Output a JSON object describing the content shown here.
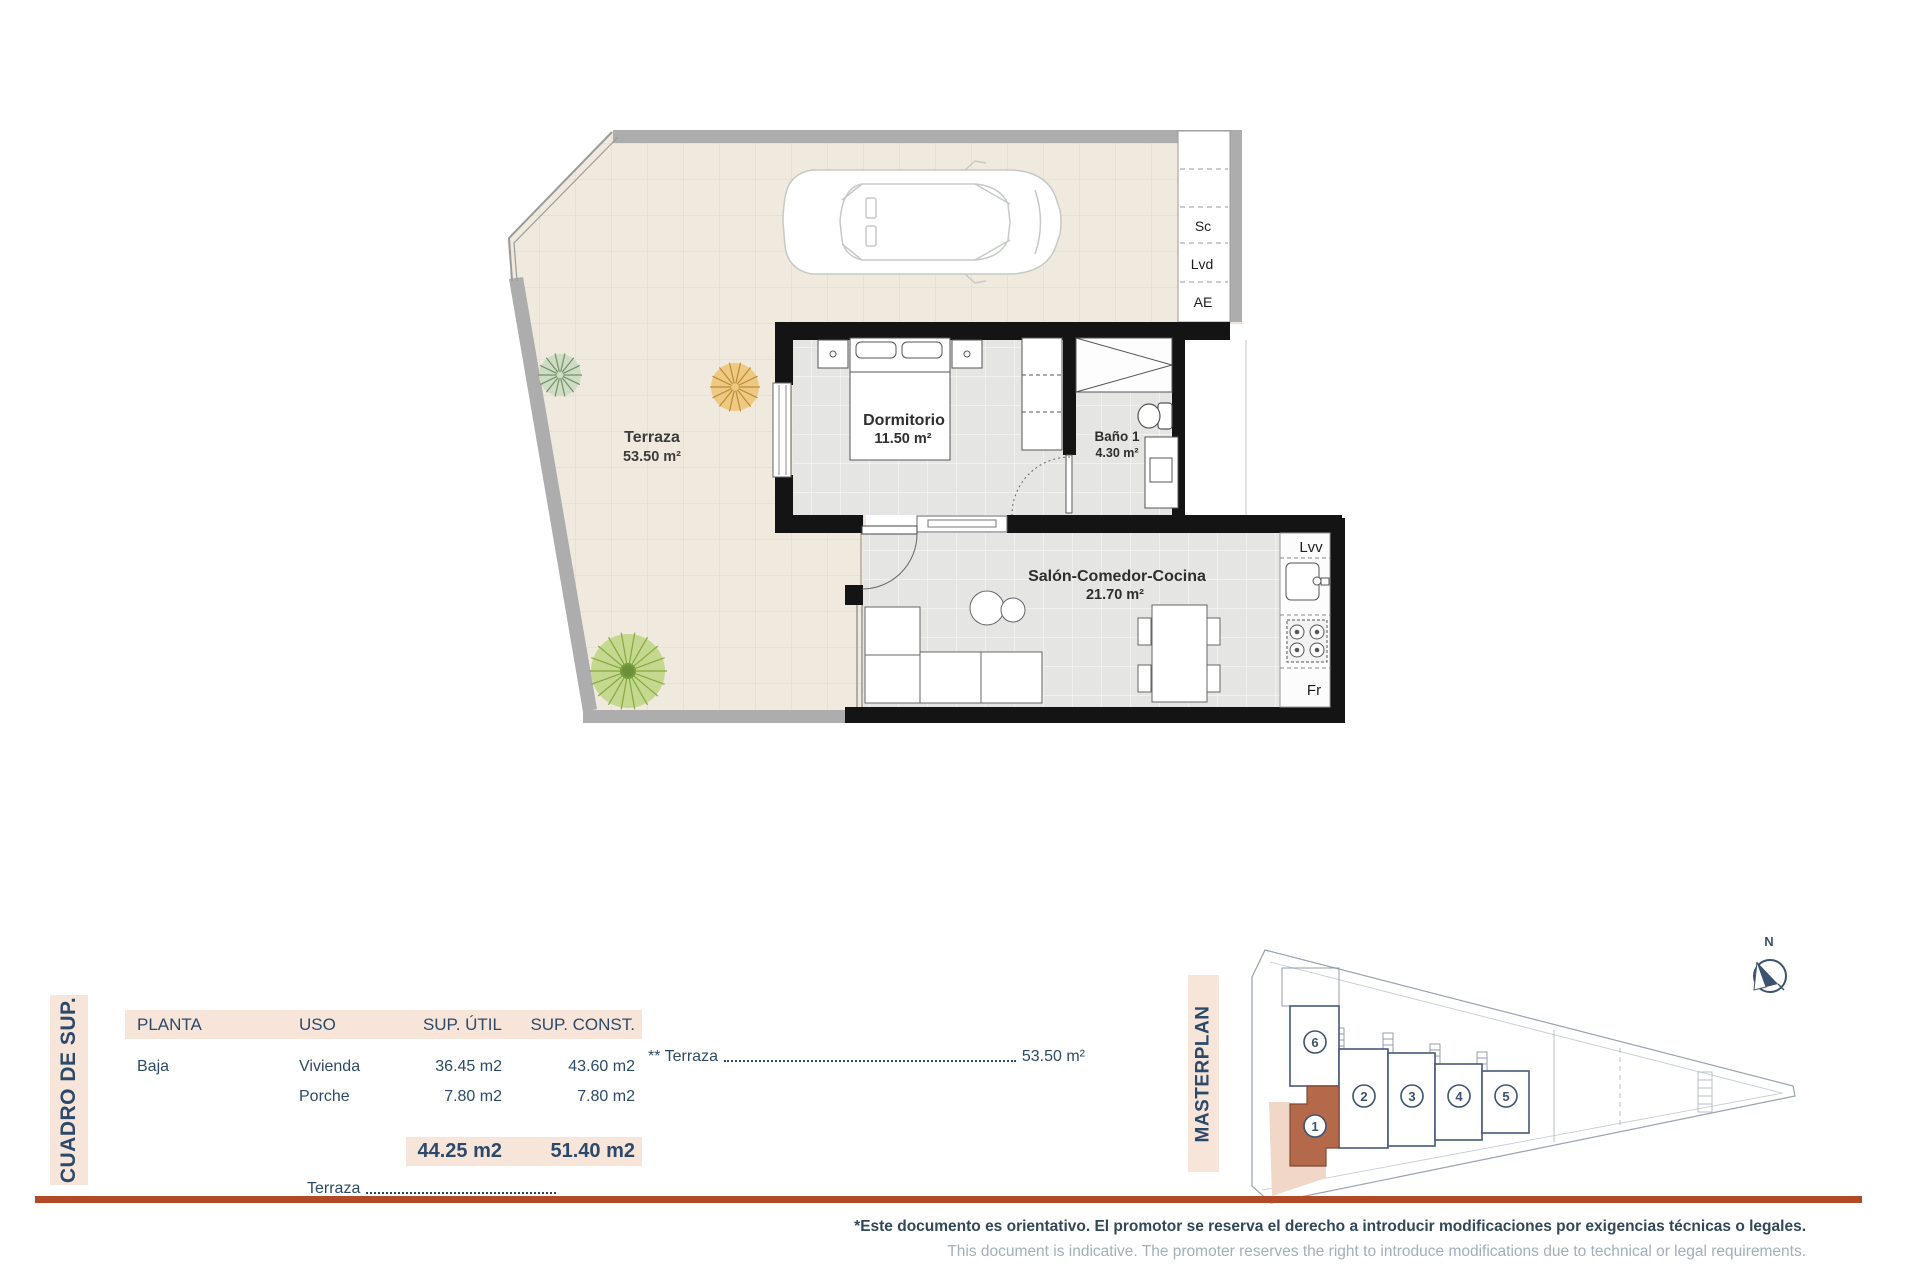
{
  "plan": {
    "terrace": {
      "name": "Terraza",
      "area": "53.50 m²"
    },
    "bedroom": {
      "name": "Dormitorio",
      "area": "11.50 m²"
    },
    "bathroom": {
      "name": "Baño 1",
      "area": "4.30 m²"
    },
    "living": {
      "name": "Salón-Comedor-Cocina",
      "area": "21.70 m²"
    },
    "utilities": {
      "sc": "Sc",
      "lvd": "Lvd",
      "ae": "AE",
      "lvv": "Lvv",
      "fr": "Fr"
    }
  },
  "table": {
    "title": "CUADRO DE SUP.",
    "headers": {
      "planta": "PLANTA",
      "uso": "USO",
      "sup_util": "SUP. ÚTIL",
      "sup_const": "SUP. CONST."
    },
    "rows": [
      {
        "planta": "Baja",
        "uso": "Vivienda",
        "sup_util": "36.45 m2",
        "sup_const": "43.60 m2"
      },
      {
        "planta": "",
        "uso": "Porche",
        "sup_util": "7.80 m2",
        "sup_const": "7.80 m2"
      }
    ],
    "totals": {
      "sup_util": "44.25 m2",
      "sup_const": "51.40 m2"
    },
    "terrace_note": {
      "label": "** Terraza",
      "value": "53.50 m²"
    },
    "terrace_partial": {
      "label": "Terraza"
    }
  },
  "masterplan": {
    "title": "MASTERPLAN",
    "north": "N",
    "units": [
      "1",
      "2",
      "3",
      "4",
      "5",
      "6"
    ],
    "highlighted_unit": "1"
  },
  "footer": {
    "disclaimer_es": "*Este documento es orientativo. El promotor se reserva el derecho a introducir modificaciones por exigencias técnicas o legales.",
    "disclaimer_en": "This document is indicative. The promoter reserves the right to introduce modifications due to technical or legal requirements."
  },
  "colors": {
    "accent_rule": "#b14a26",
    "highlight_terracotta": "#b4694b",
    "panel_pink": "#f8e5da",
    "text_navy": "#2b4a6b"
  }
}
